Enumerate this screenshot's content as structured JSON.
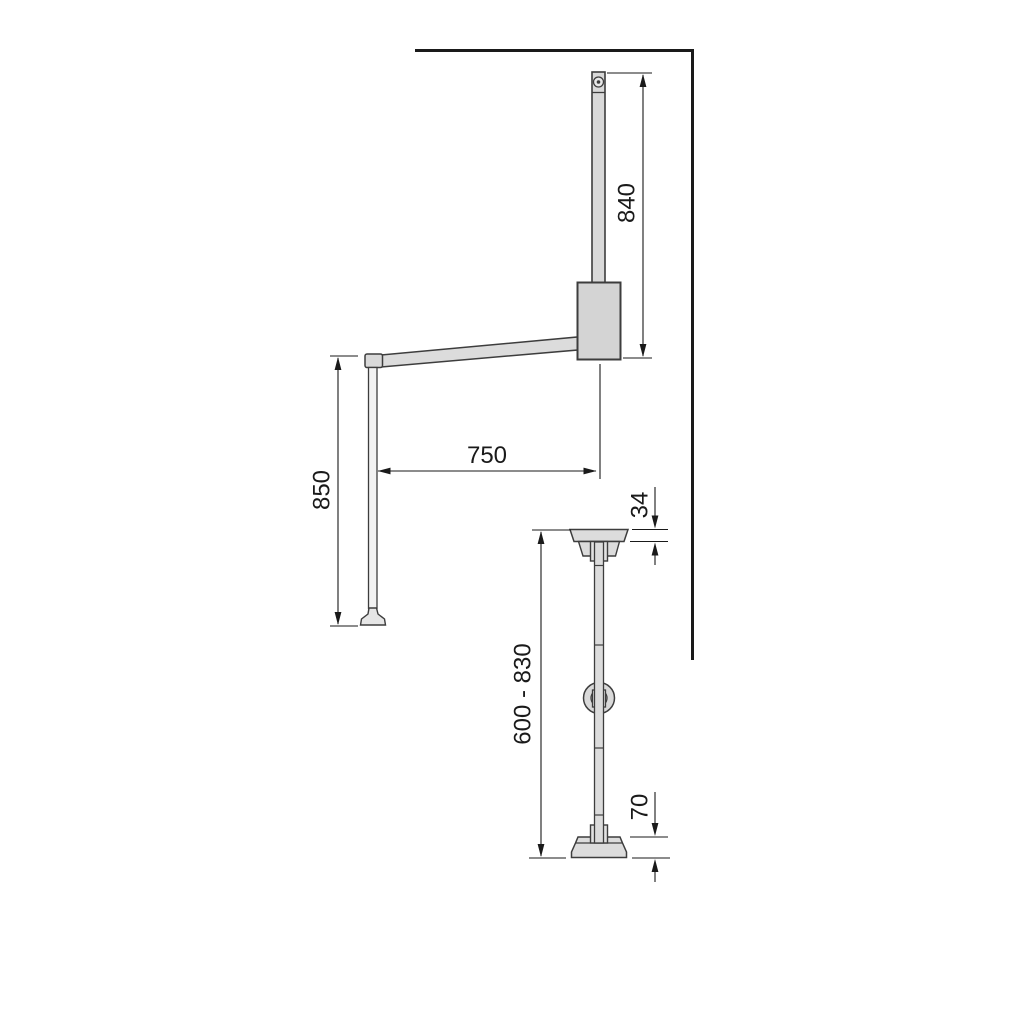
{
  "drawing": {
    "type": "technical-dimension-drawing",
    "views": {
      "side_view": "wall-mounted pull-down wardrobe lift, side profile with mounting bar, body, swing arm and pull handle pole",
      "front_view": "wardrobe lift support rod, front profile with top cap, adjuster knob and base flange"
    }
  },
  "dimensions": {
    "bar_height": "840",
    "arm_reach": "750",
    "pole_height": "850",
    "cap_height": "34",
    "adjustable_range": "600 - 830",
    "base_height": "70"
  },
  "colors": {
    "background": "#ffffff",
    "wall_outline": "#1a1a1a",
    "part_outline": "#3d3d3d",
    "part_fill": "#d9d9d9",
    "part_fill_light": "#e8e8e8",
    "pole_fill": "#f2f2f2",
    "dimension_lines": "#1a1a1a"
  }
}
